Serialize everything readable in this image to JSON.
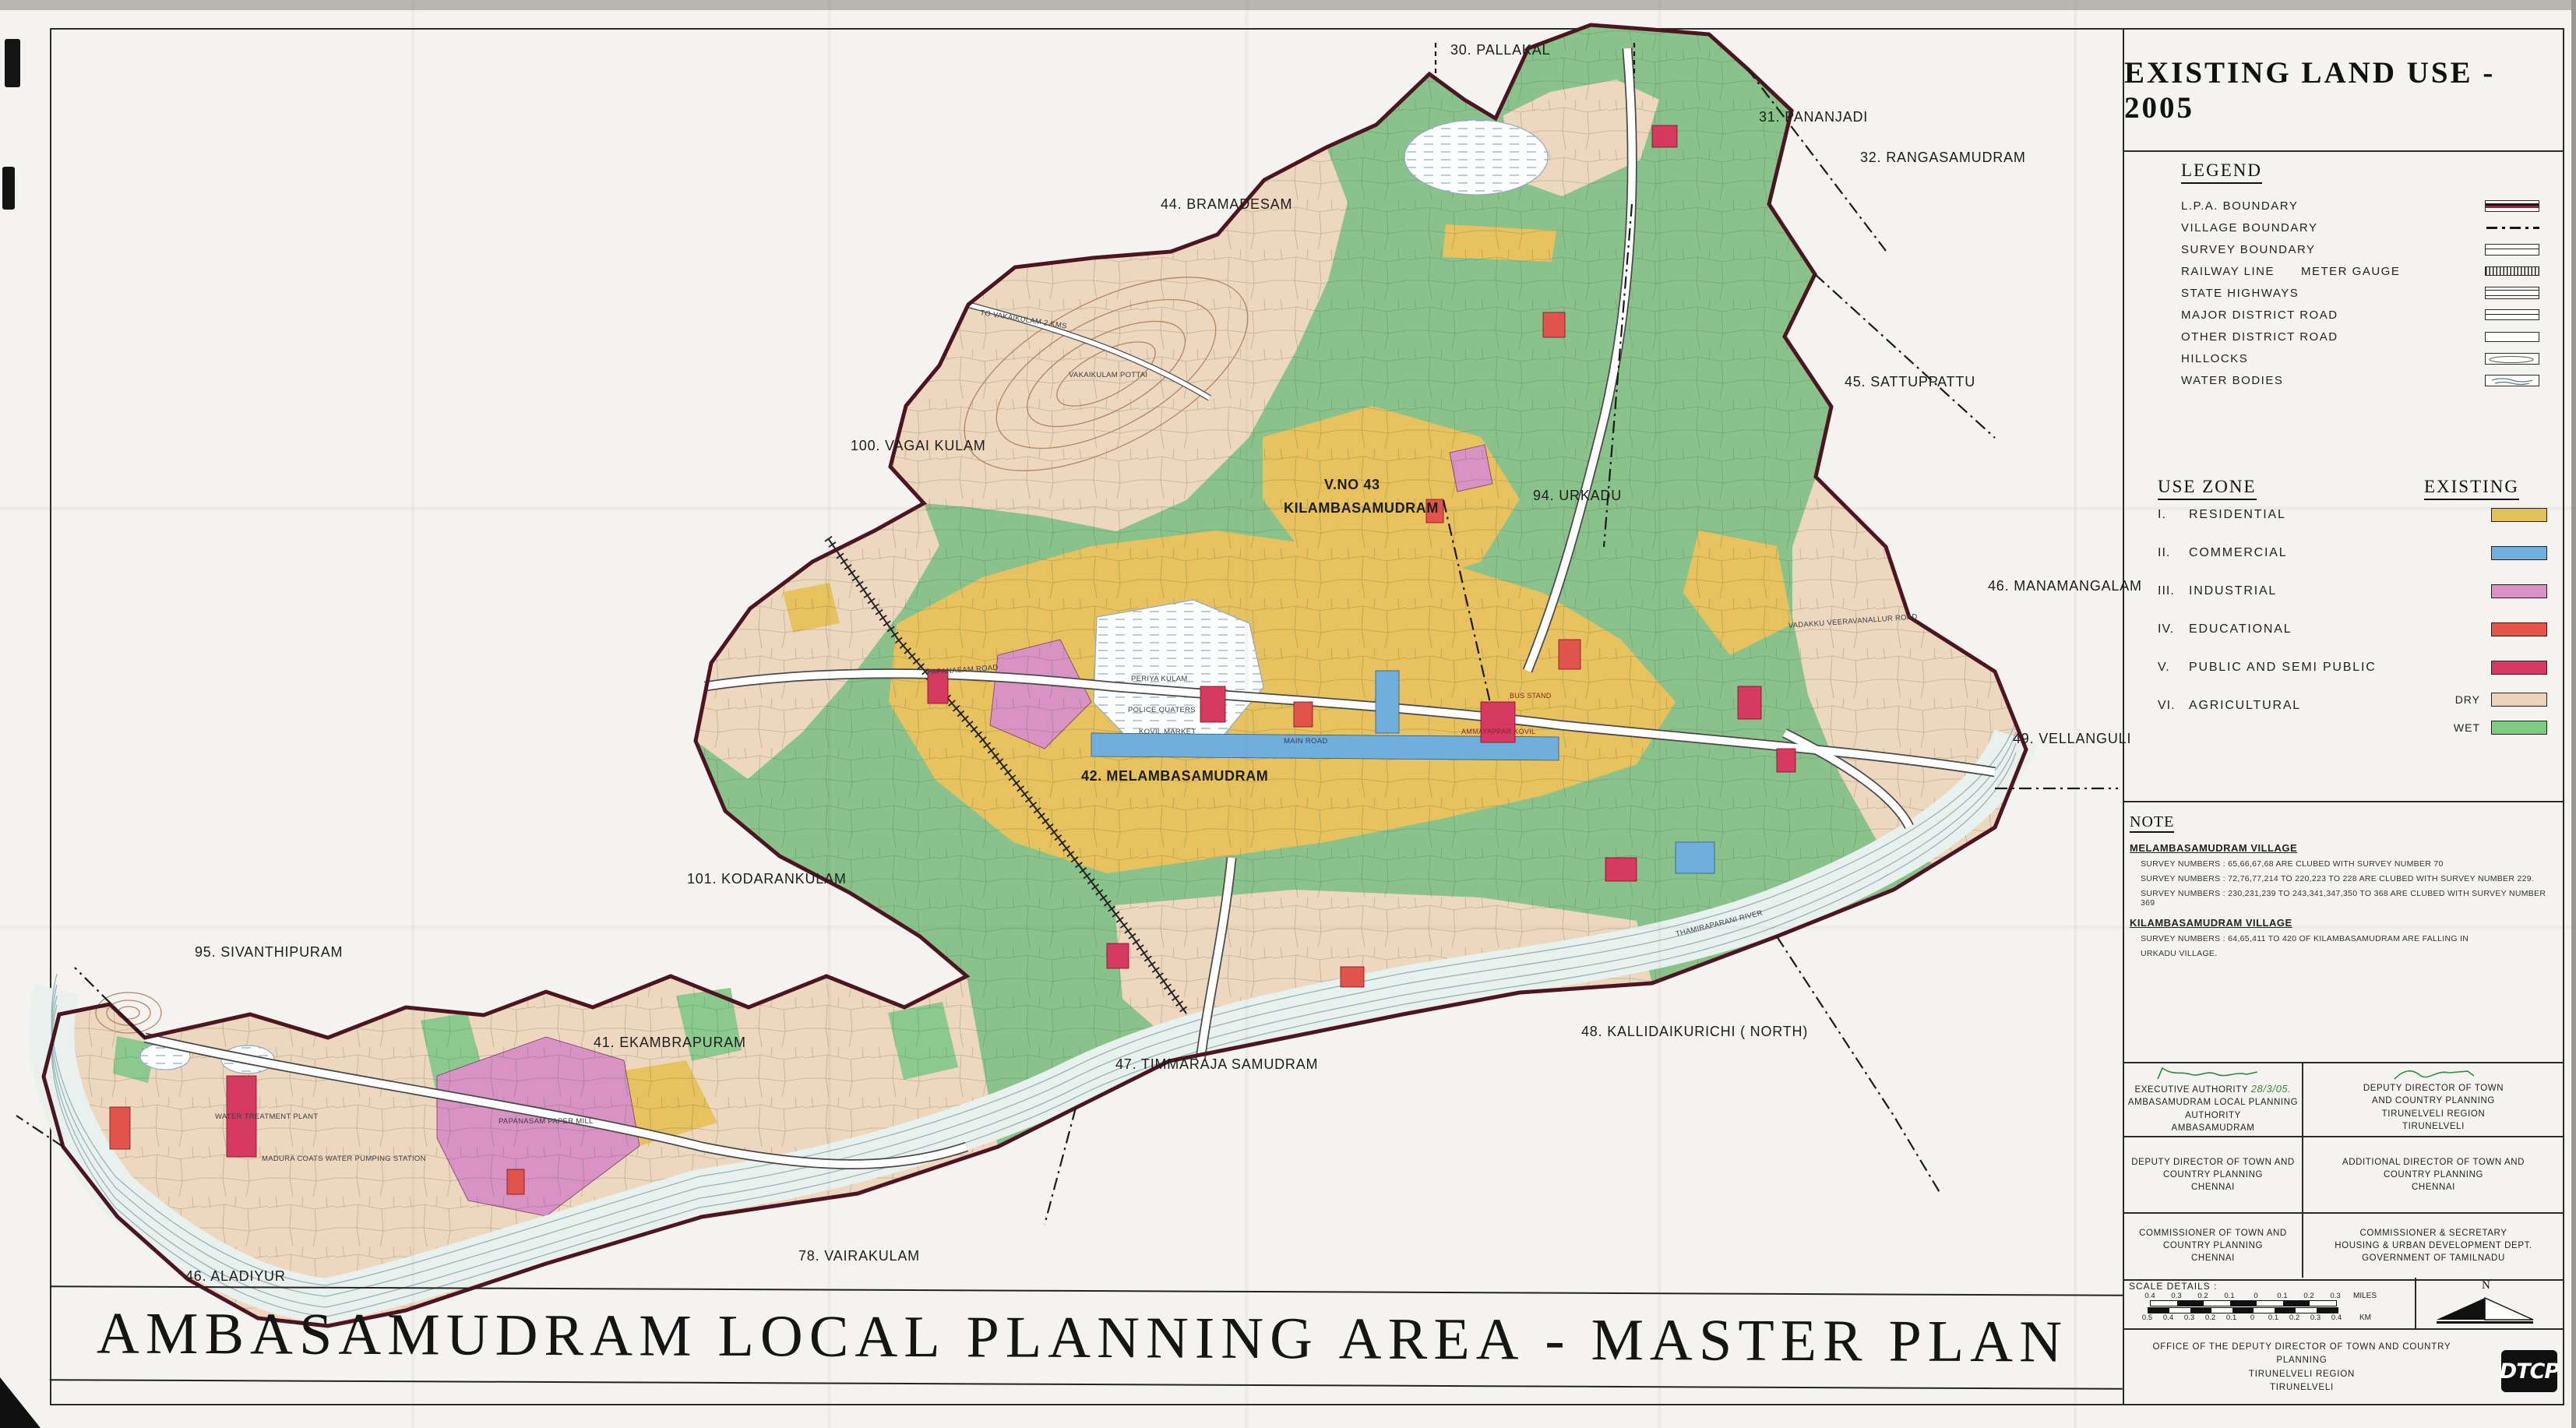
{
  "title_block": {
    "title": "EXISTING LAND USE - 2005"
  },
  "legend": {
    "heading": "LEGEND",
    "items": [
      {
        "label": "L.P.A.  BOUNDARY"
      },
      {
        "label": "VILLAGE  BOUNDARY"
      },
      {
        "label": "SURVEY  BOUNDARY"
      },
      {
        "label": "RAILWAY  LINE",
        "label2": "METER  GAUGE"
      },
      {
        "label": "STATE  HIGHWAYS"
      },
      {
        "label": "MAJOR  DISTRICT  ROAD"
      },
      {
        "label": "OTHER  DISTRICT  ROAD"
      },
      {
        "label": "HILLOCKS"
      },
      {
        "label": "WATER  BODIES"
      }
    ]
  },
  "use_zone": {
    "heading": "USE  ZONE",
    "existing_heading": "EXISTING",
    "items": [
      {
        "numeral": "I.",
        "label": "RESIDENTIAL",
        "color": "#e2c05a"
      },
      {
        "numeral": "II.",
        "label": "COMMERCIAL",
        "color": "#6fb0de"
      },
      {
        "numeral": "III.",
        "label": "INDUSTRIAL",
        "color": "#d992c5"
      },
      {
        "numeral": "IV.",
        "label": "EDUCATIONAL",
        "color": "#e6554a"
      },
      {
        "numeral": "V.",
        "label": "PUBLIC  AND  SEMI  PUBLIC",
        "color": "#d63a62"
      },
      {
        "numeral": "VI.",
        "label": "AGRICULTURAL",
        "dry_label": "DRY",
        "dry_color": "#ecd2b8",
        "wet_label": "WET",
        "wet_color": "#7fcb84"
      }
    ]
  },
  "note": {
    "heading": "NOTE",
    "village1_heading": "MELAMBASAMUDRAM VILLAGE",
    "village1_lines": [
      "SURVEY NUMBERS : 65,66,67,68 ARE CLUBED WITH SURVEY NUMBER 70",
      "SURVEY NUMBERS : 72,76,77,214 TO 220,223 TO 228 ARE CLUBED WITH SURVEY NUMBER 229.",
      "SURVEY NUMBERS : 230,231,239 TO 243,341,347,350 TO 368 ARE CLUBED WITH SURVEY NUMBER 369"
    ],
    "village2_heading": "KILAMBASAMUDRAM VILLAGE",
    "village2_lines": [
      "SURVEY NUMBERS : 64,65,411 TO 420 OF KILAMBASAMUDRAM ARE FALLING IN",
      "URKADU VILLAGE."
    ]
  },
  "signatures": {
    "row1_left_date": "28/3/05.",
    "row1_left": [
      "EXECUTIVE AUTHORITY",
      "AMBASAMUDRAM  LOCAL  PLANNING  AUTHORITY",
      "AMBASAMUDRAM"
    ],
    "row1_right": [
      "DEPUTY  DIRECTOR  OF  TOWN",
      "AND  COUNTRY  PLANNING",
      "TIRUNELVELI REGION",
      "TIRUNELVELI"
    ],
    "row2_left": [
      "DEPUTY  DIRECTOR  OF  TOWN  AND",
      "COUNTRY  PLANNING",
      "CHENNAI"
    ],
    "row2_right": [
      "ADDITIONAL  DIRECTOR  OF  TOWN  AND",
      "COUNTRY  PLANNING",
      "CHENNAI"
    ],
    "row3_left": [
      "COMMISSIONER  OF  TOWN  AND",
      "COUNTRY  PLANNING",
      "CHENNAI"
    ],
    "row3_right": [
      "COMMISSIONER  &  SECRETARY",
      "HOUSING  &  URBAN  DEVELOPMENT  DEPT.",
      "GOVERNMENT  OF  TAMILNADU"
    ]
  },
  "scale": {
    "heading": "SCALE  DETAILS :",
    "miles_labels": [
      "0.4",
      "0.3",
      "0.2",
      "0.1",
      "0",
      "0.1",
      "0.2",
      "0.3"
    ],
    "miles_unit": "MILES",
    "km_labels": [
      "0.5",
      "0.4",
      "0.3",
      "0.2",
      "0.1",
      "0",
      "0.1",
      "0.2",
      "0.3",
      "0.4"
    ],
    "km_unit": "KM",
    "north": "N"
  },
  "office": {
    "lines": [
      "OFFICE  OF  THE  DEPUTY  DIRECTOR  OF  TOWN  AND  COUNTRY  PLANNING",
      "TIRUNELVELI  REGION",
      "TIRUNELVELI"
    ],
    "logo": "DTCP"
  },
  "banner": {
    "words": [
      "AMBASAMUDRAM",
      "LOCAL",
      "PLANNING",
      "AREA",
      "-",
      "MASTER",
      "PLAN"
    ]
  },
  "map": {
    "village_labels": [
      "30. PALLAKAL",
      "31. PANANJADI",
      "32. RANGASAMUDRAM",
      "44. BRAMADESAM",
      "45. SATTUPPATTU",
      "100. VAGAI KULAM",
      "V.NO 43",
      "KILAMBASAMUDRAM",
      "94. URKADU",
      "46. MANAMANGALAM",
      "49. VELLANGULI",
      "42. MELAMBASAMUDRAM",
      "101. KODARANKULAM",
      "95. SIVANTHIPURAM",
      "41. EKAMBRAPURAM",
      "47. TIMMARAJA SAMUDRAM",
      "48. KALLIDAIKURICHI ( NORTH)",
      "78. VAIRAKULAM",
      "46. ALADIYUR"
    ],
    "micro_labels": [
      "PERIYA KULAM",
      "THAMIRAPARANI RIVER",
      "VAKAIKULAM POTTAI",
      "TO VAKAIKULAM 2 KMS",
      "PAPANASAM ROAD",
      "MAIN ROAD",
      "BUS STAND",
      "AMMAYAPPAR KOVIL",
      "KOVIL MARKET",
      "POLICE QUATERS",
      "WATER TREATMENT PLANT",
      "PAPANASAM PAPER MILL",
      "MADURA COATS WATER PUMPING STATION",
      "VADAKKU VEERAVANALLUR ROAD"
    ],
    "colors": {
      "agricultural_wet": "#8ac28c",
      "agricultural_dry": "#edd7bf",
      "residential": "#e7c25f",
      "commercial": "#70aede",
      "industrial": "#d892c4",
      "educational": "#e0544b",
      "public_semi_public": "#d6395f",
      "water": "#e9f1ee",
      "lpa_boundary": "#4d1522"
    }
  }
}
